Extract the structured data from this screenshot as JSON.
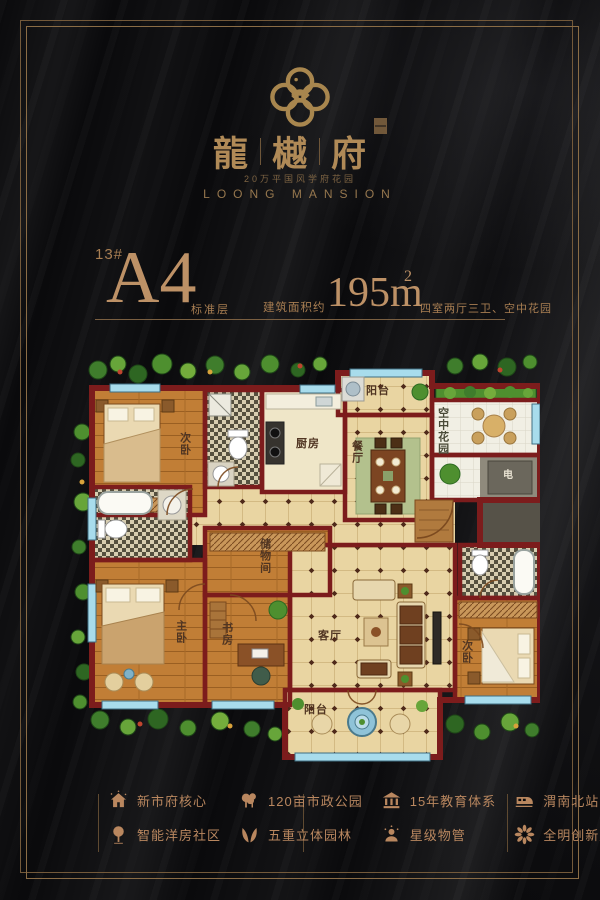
{
  "brand": {
    "chars": [
      "龍",
      "樾",
      "府"
    ],
    "tagline": "20万平国风学府花园",
    "name_en": "LOONG MANSION"
  },
  "unit": {
    "building": "13#",
    "type": "A4",
    "floor_note": "标准层",
    "area_label": "建筑面积约",
    "area_value": "195m",
    "area_sup": "2",
    "layout": "四室两厅三卫、空中花园"
  },
  "floorplan": {
    "rooms": {
      "bedroom_left": "次卧",
      "kitchen": "厨房",
      "balcony_top": "阳台",
      "dining": "餐厅",
      "sky_garden": "空中花园",
      "elevator": "电",
      "storage": "储物间",
      "master": "主卧",
      "study": "书房",
      "living": "客厅",
      "balcony_bottom": "阳台",
      "bedroom_right": "次卧"
    }
  },
  "features": {
    "items": [
      {
        "icon": "house-icon",
        "label": "新市府核心"
      },
      {
        "icon": "park-trees-icon",
        "label": "120亩市政公园"
      },
      {
        "icon": "education-icon",
        "label": "15年教育体系"
      },
      {
        "icon": "train-icon",
        "label": "渭南北站"
      },
      {
        "icon": "tree-icon",
        "label": "智能洋房社区"
      },
      {
        "icon": "wings-icon",
        "label": "五重立体园林"
      },
      {
        "icon": "service-star-icon",
        "label": "星级物管"
      },
      {
        "icon": "flower-icon",
        "label": "全明创新户型"
      }
    ]
  },
  "colors": {
    "accent_gold": "#b9875f",
    "wall_red": "#7c1c1c",
    "background": "#0a0a0c",
    "floor_tan": "#e9d5a2",
    "wood": "#c17e36",
    "window_blue": "#a8dcec"
  }
}
